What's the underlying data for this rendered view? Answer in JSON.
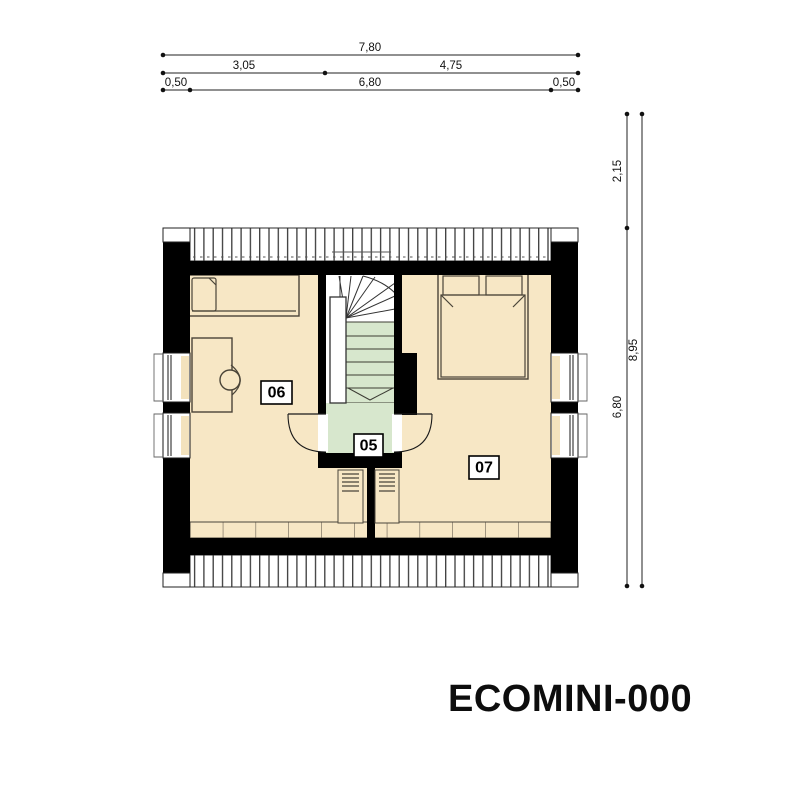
{
  "title": "ECOMINI-000",
  "rooms": {
    "landing": "05",
    "bedroom_left": "06",
    "bedroom_right": "07"
  },
  "dimensions_top": {
    "total": "7,80",
    "seg_left": "3,05",
    "seg_right": "4,75",
    "wall_left": "0,50",
    "interior": "6,80",
    "wall_right": "0,50"
  },
  "dimensions_right": {
    "upper": "2,15",
    "lower": "6,80",
    "total": "8,95"
  },
  "colors": {
    "floor": "#f7e7c5",
    "stairs": "#d7e7cd",
    "wall": "#000000",
    "paper": "#ffffff"
  }
}
